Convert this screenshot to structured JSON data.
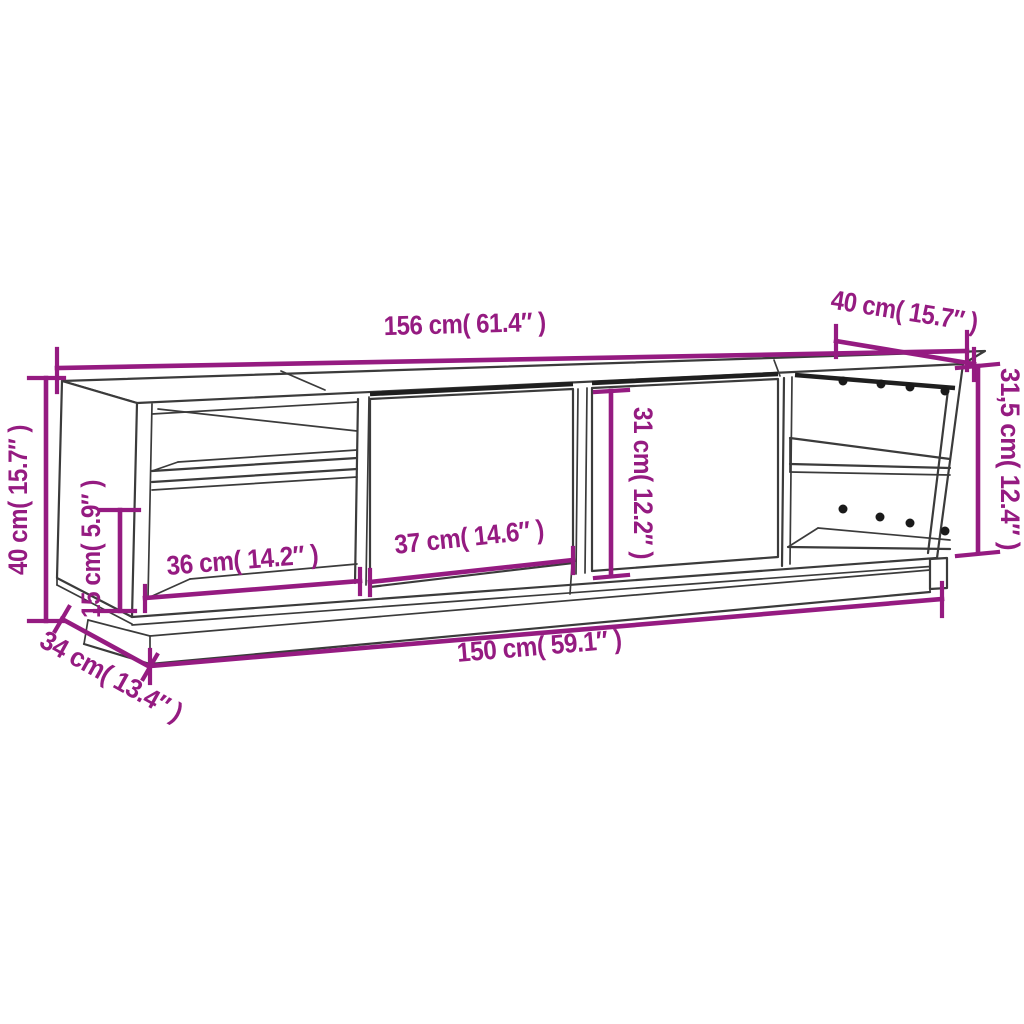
{
  "diagram": {
    "type": "furniture-dimension-drawing",
    "colors": {
      "accent": "#951b81",
      "line": "#3b3b3b",
      "background": "#ffffff"
    },
    "dims": [
      {
        "id": "top-width",
        "label": "156 cm( 61.4″ )"
      },
      {
        "id": "top-depth",
        "label": "40 cm( 15.7″ )"
      },
      {
        "id": "right-height",
        "label": "31,5 cm( 12.4″ )"
      },
      {
        "id": "left-height",
        "label": "40 cm( 15.7″ )"
      },
      {
        "id": "left-lower-height",
        "label": "15 cm( 5.9″ )"
      },
      {
        "id": "left-compartment-width",
        "label": "36 cm( 14.2″ )"
      },
      {
        "id": "door-width",
        "label": "37 cm( 14.6″ )"
      },
      {
        "id": "door-height",
        "label": "31 cm( 12.2″ )"
      },
      {
        "id": "bottom-width",
        "label": "150 cm( 59.1″ )"
      },
      {
        "id": "base-depth",
        "label": "34 cm( 13.4″ )"
      }
    ],
    "peg_hole_count": 8
  }
}
